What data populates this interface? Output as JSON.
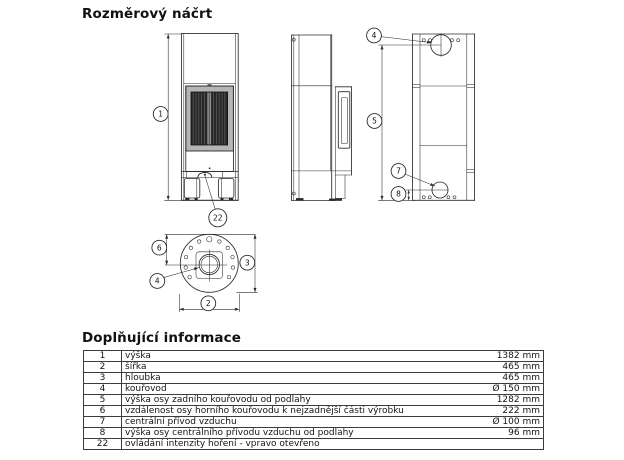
{
  "titles": {
    "drawing": "Rozměrový náčrt",
    "info": "Doplňující informace"
  },
  "balloons": {
    "b1": "1",
    "b2": "2",
    "b3": "3",
    "b4": "4",
    "b5": "5",
    "b6": "6",
    "b7": "7",
    "b8": "8",
    "b22": "22"
  },
  "table": {
    "rows": [
      {
        "num": "1",
        "desc": "výška",
        "val": "1382 mm"
      },
      {
        "num": "2",
        "desc": "šířka",
        "val": "465 mm"
      },
      {
        "num": "3",
        "desc": "hloubka",
        "val": "465 mm"
      },
      {
        "num": "4",
        "desc": "kouřovod",
        "val": "Ø 150 mm"
      },
      {
        "num": "5",
        "desc": "výška osy zadního kouřovodu od podlahy",
        "val": "1282 mm"
      },
      {
        "num": "6",
        "desc": "vzdálenost osy horního kouřovodu k nejzadnější části výrobku",
        "val": "222 mm"
      },
      {
        "num": "7",
        "desc": "centrální přívod vzduchu",
        "val": "Ø 100 mm"
      },
      {
        "num": "8",
        "desc": "výška osy centrálního přívodu vzduchu od podlahy",
        "val": "96 mm"
      },
      {
        "num": "22",
        "desc": "ovládání intenzity hoření - vpravo otevřeno",
        "val": ""
      }
    ]
  }
}
